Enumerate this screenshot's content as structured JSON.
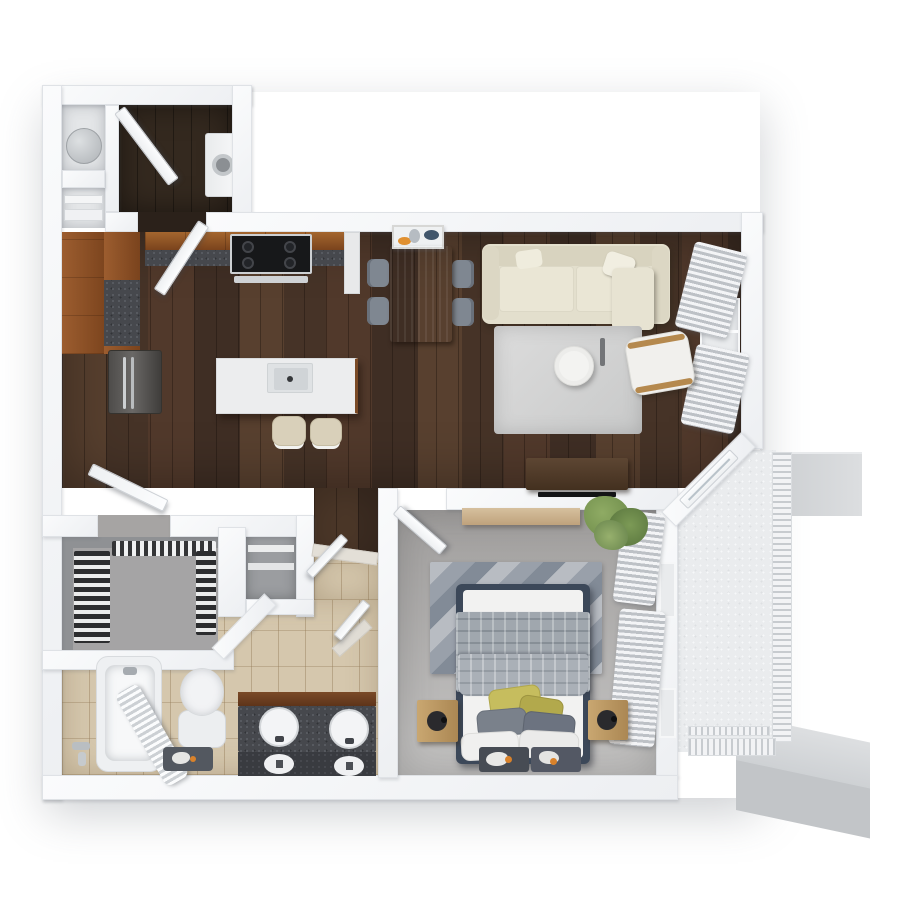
{
  "scene": {
    "description": "3D top-down rendered floor plan of a one-bedroom, one-bathroom apartment with balcony",
    "background": "#ffffff"
  },
  "palette": {
    "wall": "#f2f3f5",
    "wood_floor": "#4e392c",
    "entry_floor": "#32281f",
    "bedroom_carpet": "#aaa8a6",
    "bathroom_tile": "#d5c7ad",
    "closet_floor": "#a5a4a5",
    "balcony_floor": "#eaecee",
    "cabinet_wood": "#8e5229",
    "countertop": "#46484d",
    "stainless": "#5d5b59",
    "island_white": "#ecedee",
    "sofa_cream": "#e3dfcd",
    "rug_gray": "#d6d7d7",
    "dining_table_wood": "#b59a78",
    "chair_gray": "#828a93",
    "bed_frame_navy": "#3c4859",
    "duvet_gray": "#a0a7ae",
    "pillow_olive": "#c6bd5e",
    "nightstand_wood": "#c1a069",
    "curtain_gray": "#bdc1c6",
    "accent_orange": "#d9822b",
    "accent_navy": "#41566b",
    "plant_green": "#7c9a56",
    "neighbor_wall_gray": "#c9cccf"
  },
  "rooms": {
    "entry": {
      "name": "Entry"
    },
    "laundry": {
      "name": "Laundry Closet"
    },
    "utility": {
      "name": "Utility Closet"
    },
    "pantry": {
      "name": "Storage Closet"
    },
    "kitchen": {
      "name": "Kitchen"
    },
    "dining": {
      "name": "Dining Area"
    },
    "living": {
      "name": "Living Room"
    },
    "hallway": {
      "name": "Hallway"
    },
    "closet": {
      "name": "Walk-in Closet"
    },
    "linen": {
      "name": "Linen Closet"
    },
    "bathroom": {
      "name": "Bathroom"
    },
    "bedroom": {
      "name": "Bedroom"
    },
    "balcony": {
      "name": "Balcony"
    }
  },
  "items": {
    "front_door": "Entry Door",
    "interior_door": "Interior Door",
    "balcony_door": "Sliding Balcony Door",
    "washer": "Stacked Washer Dryer",
    "water_heater": "Water Heater",
    "shelves": "Storage Shelves",
    "fridge": "Refrigerator",
    "stove": "Range with Cooktop",
    "cabinets": "Kitchen Cabinets",
    "island": "Kitchen Island with Sink",
    "stool": "Bar Stool",
    "dining_table": "Dining Table",
    "dining_chair": "Dining Chair",
    "wall_art": "Wall Art",
    "sofa": "Sofa",
    "coffee_table": "Round Coffee Table",
    "area_rug": "Area Rug",
    "accent_chair": "Accent Chair",
    "tv_console": "Media Console with TV",
    "curtains": "Curtains",
    "window": "Window",
    "bed": "Bed with Pillows",
    "nightstand": "Nightstand",
    "bed_rug": "Bedroom Rug",
    "foot_rug": "Runner Rug",
    "plant": "Potted Plant",
    "shelf": "Wall Shelf",
    "tub": "Bathtub",
    "shower_curtain": "Shower Curtain",
    "toilet": "Toilet",
    "vanity": "Double Sink Vanity",
    "bath_mat": "Bath Mat",
    "clothes": "Hanging Clothes",
    "railing": "Balcony Railing",
    "neighbor_wall": "Adjoining Wall Stub"
  }
}
